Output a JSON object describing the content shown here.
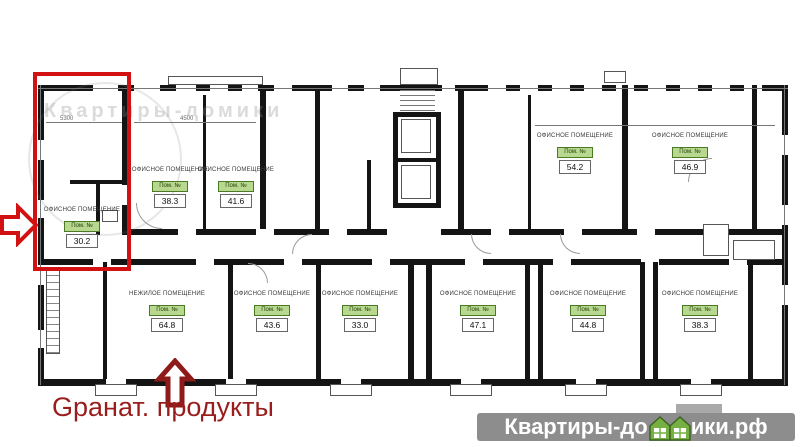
{
  "plan": {
    "rooms": [
      {
        "title": "ОФИСНОЕ ПОМЕЩЕНИЕ",
        "badge": "Пом. №",
        "area": "30.2"
      },
      {
        "title": "ОФИСНОЕ ПОМЕЩЕНИЕ",
        "badge": "Пом. №",
        "area": "38.3"
      },
      {
        "title": "ОФИСНОЕ ПОМЕЩЕНИЕ",
        "badge": "Пом. №",
        "area": "41.6"
      },
      {
        "title": "ОФИСНОЕ ПОМЕЩЕНИЕ",
        "badge": "Пом. №",
        "area": "54.2"
      },
      {
        "title": "ОФИСНОЕ ПОМЕЩЕНИЕ",
        "badge": "Пом. №",
        "area": "46.9"
      },
      {
        "title": "НЕЖИЛОЕ ПОМЕЩЕНИЕ",
        "badge": "Пом. №",
        "area": "64.8"
      },
      {
        "title": "ОФИСНОЕ ПОМЕЩЕНИЕ",
        "badge": "Пом. №",
        "area": "43.6"
      },
      {
        "title": "ОФИСНОЕ ПОМЕЩЕНИЕ",
        "badge": "Пом. №",
        "area": "33.0"
      },
      {
        "title": "ОФИСНОЕ ПОМЕЩЕНИЕ",
        "badge": "Пом. №",
        "area": "47.1"
      },
      {
        "title": "ОФИСНОЕ ПОМЕЩЕНИЕ",
        "badge": "Пом. №",
        "area": "44.8"
      },
      {
        "title": "ОФИСНОЕ ПОМЕЩЕНИЕ",
        "badge": "Пом. №",
        "area": "38.3"
      }
    ],
    "dimensions": [
      "5300",
      "4500"
    ],
    "watermark_text": "Квартиры-домики"
  },
  "annotations": {
    "store_label": "Gранат. продукты"
  },
  "footer_watermark": {
    "prefix": "Квартиры-до",
    "suffix": "ики.рф",
    "icon": "green-houses-icon"
  },
  "colors": {
    "highlight_red": "#d21212",
    "annotation_dark_red": "#8e1a1a",
    "badge_green_bg": "#b9d88f",
    "badge_green_border": "#4a7a22",
    "footer_gray": "#8d8d8d",
    "house_green": "#76b043"
  }
}
